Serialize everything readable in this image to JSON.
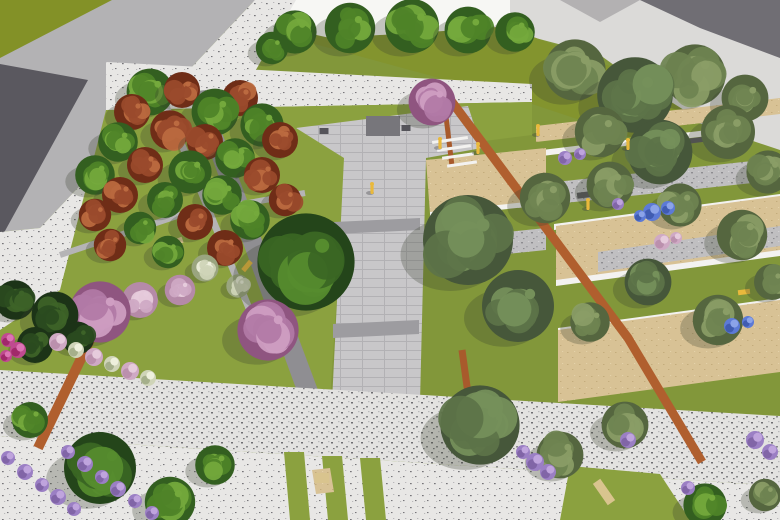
{
  "scene": {
    "description": "Aerial 3D rendering of a park landscape design with tree grove, central paved walkway, terraced sand garden, flower beds and promenade",
    "palette": {
      "lawn_base": "#82973a",
      "lawn_top": "#83942e",
      "lawn_bright": "#8ba13f",
      "olive_corner": "#839127",
      "road": "#b3b2b4",
      "road_shadow": "#504e55",
      "sidewalk_bg": "#e8e7e5",
      "speck_dark": "#77767a",
      "speck_mid": "#b9b8ba",
      "building_white": "#f7f7f4",
      "building_shade": "#e4e3e1",
      "pav_topright": "#dbdad8",
      "shadow_dark": "#55525b",
      "plaza_bg": "#c8c7c9",
      "plaza_line": "#b2b1b4",
      "plaza_dark": "#9d9ca0",
      "stone_bg": "#c0bfc1",
      "sand": "#d8c295",
      "sand_dot": "#c3ac7c",
      "white_wall": "#f3f2f0",
      "grove_band": "#8f8e92",
      "grove_path": "#b5b4b6",
      "corten": "#b05f2e",
      "trunk": "#a85a2c",
      "monument": "#77767b",
      "monument_dark": "#55545a",
      "yellow": "#e9b93c",
      "tan_bench": "#d9c48e",
      "dark_bench": "#5a595e",
      "shadow_veg": "#39402e"
    },
    "tree_palettes": {
      "g": [
        "#335f20",
        "#4f8328",
        "#74a93c"
      ],
      "gd": [
        "#24451a",
        "#3a6623",
        "#568c2e"
      ],
      "o": [
        "#55663f",
        "#6e8351",
        "#8a9d66"
      ],
      "od": [
        "#46573a",
        "#5d7348",
        "#75905a"
      ],
      "r": [
        "#6f2d17",
        "#9a4a2c",
        "#bb6a40"
      ],
      "p": [
        "#8f5580",
        "#b27aa6",
        "#cf9ec2"
      ],
      "pl": [
        "#b58aa8",
        "#cfa9c4",
        "#e6cbdc"
      ],
      "c": [
        "#1c3317",
        "#2a4a1f",
        "#3d6328"
      ],
      "w": [
        "#9aa57f",
        "#cfd4b8",
        "#eef0dd"
      ],
      "l": [
        "#7a5fa0",
        "#9b7fc4",
        "#bfa4dd"
      ],
      "m": [
        "#992060",
        "#c04a90",
        "#dd74b4"
      ],
      "b": [
        "#3a55a8",
        "#5c7ad6",
        "#8ba3e8"
      ]
    },
    "grounds": [
      {
        "name": "base-lawn",
        "pts": "0,0 780,0 780,520 0,520",
        "fill": "lawn_base"
      },
      {
        "name": "top-right-pavement",
        "pts": "470,0 780,0 780,150 690,120 600,55 505,30",
        "fill": "pav_topright"
      },
      {
        "name": "top-lawn-band",
        "pts": "258,16 510,28 620,70 700,120 640,140 520,100 300,40",
        "fill": "lawn_top"
      },
      {
        "name": "buildings-top",
        "pts": "252,0 510,0 510,26 430,32 330,38 258,22",
        "fill": "building_white"
      },
      {
        "name": "building-facet",
        "pts": "252,0 292,0 262,26",
        "fill": "building_shade"
      },
      {
        "name": "top-shadow-wedge",
        "pts": "640,0 780,0 780,58 700,28",
        "fill": "shadow_dark",
        "op": 0.8
      },
      {
        "name": "top-shadow-wedge-2",
        "pts": "560,0 640,0 600,22",
        "fill": "shadow_dark",
        "op": 0.3
      },
      {
        "name": "olive-corner",
        "pts": "0,0 112,0 0,58",
        "fill": "olive_corner"
      },
      {
        "name": "road",
        "pts": "112,0 255,0 40,228 0,232 0,58",
        "fill": "road"
      },
      {
        "name": "road-shadow",
        "pts": "0,64 88,80 0,240",
        "fill": "road_shadow",
        "op": 0.9
      },
      {
        "name": "sidewalk",
        "pts": "255,0 296,0 100,342 62,372 0,372 0,232 40,228",
        "fill": "@speckle"
      },
      {
        "name": "white-strip",
        "pts": "106,62 532,84 532,102 106,110",
        "fill": "@speckle"
      },
      {
        "name": "lawn-bright-grove",
        "pts": "106,110 532,102 532,135 430,148 346,158 330,400 0,374 0,330 60,290",
        "fill": "lawn_bright"
      },
      {
        "name": "grove-dark-band",
        "pts": "188,92 206,90 318,390 298,394",
        "fill": "grove_band"
      },
      {
        "name": "plaza-walkway",
        "pts": "296,128 468,106 482,148 426,158 420,402 332,402 344,158",
        "fill": "@paving"
      },
      {
        "name": "walk-cross-1",
        "pts": "334,222 420,218 420,230 334,234",
        "fill": "plaza_dark"
      },
      {
        "name": "walk-cross-2",
        "pts": "333,324 419,320 419,334 333,338",
        "fill": "plaza_dark"
      },
      {
        "name": "right-sand-1",
        "pts": "536,126 780,98 780,114 536,142",
        "fill": "@sand"
      },
      {
        "name": "right-wall-1",
        "pts": "542,150 724,128 724,134 542,156",
        "fill": "white_wall"
      },
      {
        "name": "right-stone-1",
        "pts": "518,186 780,158 780,180 518,208",
        "fill": "@stone"
      },
      {
        "name": "right-wall-2",
        "pts": "554,224 780,194 780,200 554,230",
        "fill": "white_wall"
      },
      {
        "name": "right-sand-2",
        "pts": "556,226 780,196 780,252 556,282",
        "fill": "@sand"
      },
      {
        "name": "right-stone-2",
        "pts": "598,252 780,226 780,246 598,272",
        "fill": "@stone"
      },
      {
        "name": "right-wall-2b",
        "pts": "556,280 780,250 780,256 556,286",
        "fill": "white_wall"
      },
      {
        "name": "right-wall-3",
        "pts": "558,328 780,298 780,304 558,334",
        "fill": "white_wall"
      },
      {
        "name": "right-sand-3",
        "pts": "558,330 780,300 780,372 558,402",
        "fill": "@sand"
      },
      {
        "name": "left-sand-block",
        "pts": "426,160 546,148 546,204 430,214",
        "fill": "@sand"
      },
      {
        "name": "left-sand-wall",
        "pts": "430,212 546,200 546,205 430,217",
        "fill": "white_wall"
      },
      {
        "name": "left-stone-block",
        "pts": "430,240 546,228 546,250 430,262",
        "fill": "@stone"
      },
      {
        "name": "promenade",
        "pts": "0,370 780,416 780,486 0,436",
        "fill": "@speckle2"
      },
      {
        "name": "bottom-band",
        "pts": "0,436 780,486 780,520 0,520",
        "fill": "@speckle"
      },
      {
        "name": "grass-strip-1",
        "pts": "284,452 304,452 310,520 290,520",
        "fill": "lawn_bright"
      },
      {
        "name": "grass-strip-2",
        "pts": "322,456 342,456 348,520 328,520",
        "fill": "lawn_bright"
      },
      {
        "name": "grass-strip-3",
        "pts": "360,458 380,458 386,520 366,520",
        "fill": "lawn_bright"
      },
      {
        "name": "dirt-patch",
        "pts": "312,470 330,468 334,492 316,494",
        "fill": "@sand"
      },
      {
        "name": "bottom-right-lawn",
        "pts": "570,466 660,474 690,520 560,520",
        "fill": "lawn_bright"
      }
    ],
    "strokes": [
      {
        "name": "corten-path-main",
        "pts": "446,94 628,338 702,462",
        "fill": "corten",
        "w": 9
      },
      {
        "name": "corten-path-left",
        "pts": "90,340 38,448",
        "fill": "corten",
        "w": 10
      },
      {
        "name": "tall-trunk-1",
        "pts": "462,350 476,452",
        "fill": "trunk",
        "w": 7
      },
      {
        "name": "tall-trunk-2",
        "pts": "444,100 452,166",
        "fill": "trunk",
        "w": 5
      },
      {
        "name": "grove-path-1",
        "pts": "152,72 262,340",
        "fill": "grove_path",
        "w": 7
      },
      {
        "name": "grove-path-2",
        "pts": "60,255 180,215 305,193",
        "fill": "grove_path",
        "w": 6
      }
    ],
    "bars": [
      {
        "name": "monument",
        "x": 383,
        "y": 126,
        "w": 34,
        "h": 20,
        "rot": 0,
        "fill": "monument"
      },
      {
        "name": "monument-dot-left",
        "x": 324,
        "y": 131,
        "w": 9,
        "h": 6,
        "rot": 0,
        "fill": "monument_dark"
      },
      {
        "name": "monument-dot-right",
        "x": 406,
        "y": 128,
        "w": 9,
        "h": 6,
        "rot": 0,
        "fill": "monument_dark"
      },
      {
        "name": "step-1",
        "x": 450,
        "y": 140,
        "w": 36,
        "h": 3,
        "rot": -8,
        "fill": "white_wall"
      },
      {
        "name": "step-2",
        "x": 454,
        "y": 148,
        "w": 34,
        "h": 3,
        "rot": -8,
        "fill": "white_wall"
      },
      {
        "name": "step-3",
        "x": 458,
        "y": 156,
        "w": 32,
        "h": 3,
        "rot": -8,
        "fill": "white_wall"
      },
      {
        "name": "step-4",
        "x": 462,
        "y": 164,
        "w": 30,
        "h": 3,
        "rot": -8,
        "fill": "white_wall"
      },
      {
        "name": "dark-bench-1",
        "x": 592,
        "y": 194,
        "w": 30,
        "h": 6,
        "rot": -7,
        "fill": "dark_bench"
      },
      {
        "name": "dark-bench-2",
        "x": 698,
        "y": 140,
        "w": 24,
        "h": 5,
        "rot": -7,
        "fill": "dark_bench"
      },
      {
        "name": "tan-bench-1",
        "x": 176,
        "y": 242,
        "w": 14,
        "h": 6,
        "rot": -20,
        "fill": "tan_bench"
      },
      {
        "name": "tan-bench-2",
        "x": 604,
        "y": 492,
        "w": 26,
        "h": 9,
        "rot": 55,
        "fill": "tan_bench"
      },
      {
        "name": "tan-bench-3",
        "x": 322,
        "y": 478,
        "w": 14,
        "h": 10,
        "rot": 0,
        "fill": "tan_bench"
      },
      {
        "name": "yellow-bench-1",
        "x": 112,
        "y": 200,
        "w": 12,
        "h": 5,
        "rot": -50,
        "fill": "yellow"
      },
      {
        "name": "yellow-bench-2",
        "x": 247,
        "y": 266,
        "w": 12,
        "h": 5,
        "rot": -50,
        "fill": "yellow"
      },
      {
        "name": "yellow-bench-3",
        "x": 744,
        "y": 292,
        "w": 12,
        "h": 5,
        "rot": -7,
        "fill": "yellow"
      }
    ],
    "trees": [
      [
        295,
        32,
        24,
        "g"
      ],
      [
        350,
        28,
        28,
        "g"
      ],
      [
        412,
        26,
        30,
        "g"
      ],
      [
        468,
        30,
        26,
        "g"
      ],
      [
        272,
        48,
        18,
        "g"
      ],
      [
        515,
        32,
        22,
        "g"
      ],
      [
        575,
        70,
        34,
        "o"
      ],
      [
        695,
        75,
        34,
        "o"
      ],
      [
        745,
        98,
        26,
        "o"
      ],
      [
        635,
        95,
        42,
        "od"
      ],
      [
        600,
        132,
        28,
        "o"
      ],
      [
        728,
        132,
        30,
        "o"
      ],
      [
        660,
        152,
        36,
        "od"
      ],
      [
        768,
        172,
        24,
        "o"
      ],
      [
        432,
        102,
        26,
        "p"
      ],
      [
        150,
        92,
        26,
        "g"
      ],
      [
        182,
        90,
        20,
        "r"
      ],
      [
        240,
        98,
        20,
        "r"
      ],
      [
        215,
        112,
        26,
        "g"
      ],
      [
        132,
        112,
        20,
        "r"
      ],
      [
        262,
        125,
        24,
        "g"
      ],
      [
        170,
        130,
        22,
        "r"
      ],
      [
        118,
        142,
        22,
        "g"
      ],
      [
        205,
        142,
        20,
        "r"
      ],
      [
        280,
        140,
        20,
        "r"
      ],
      [
        235,
        158,
        22,
        "g"
      ],
      [
        145,
        165,
        20,
        "r"
      ],
      [
        95,
        175,
        22,
        "g"
      ],
      [
        190,
        172,
        24,
        "g"
      ],
      [
        262,
        175,
        20,
        "r"
      ],
      [
        120,
        195,
        20,
        "r"
      ],
      [
        222,
        195,
        22,
        "g"
      ],
      [
        165,
        200,
        20,
        "g"
      ],
      [
        285,
        200,
        18,
        "r"
      ],
      [
        95,
        215,
        18,
        "r"
      ],
      [
        195,
        222,
        20,
        "r"
      ],
      [
        250,
        220,
        22,
        "g"
      ],
      [
        140,
        228,
        18,
        "g"
      ],
      [
        110,
        245,
        18,
        "r"
      ],
      [
        225,
        248,
        20,
        "r"
      ],
      [
        168,
        252,
        18,
        "g"
      ],
      [
        205,
        268,
        15,
        "w"
      ],
      [
        238,
        286,
        13,
        "w"
      ],
      [
        306,
        262,
        54,
        "gd"
      ],
      [
        545,
        198,
        28,
        "o"
      ],
      [
        468,
        240,
        50,
        "od"
      ],
      [
        518,
        306,
        40,
        "od"
      ],
      [
        610,
        185,
        26,
        "o"
      ],
      [
        680,
        205,
        24,
        "o"
      ],
      [
        742,
        235,
        28,
        "o"
      ],
      [
        648,
        282,
        26,
        "od"
      ],
      [
        718,
        320,
        28,
        "o"
      ],
      [
        590,
        322,
        22,
        "o"
      ],
      [
        772,
        282,
        20,
        "o"
      ],
      [
        140,
        300,
        20,
        "pl"
      ],
      [
        180,
        290,
        17,
        "pl"
      ],
      [
        100,
        312,
        34,
        "p"
      ],
      [
        268,
        330,
        34,
        "p"
      ],
      [
        15,
        300,
        22,
        "c"
      ],
      [
        55,
        315,
        26,
        "c"
      ],
      [
        35,
        345,
        20,
        "c"
      ],
      [
        78,
        338,
        18,
        "c"
      ],
      [
        30,
        420,
        20,
        "g"
      ],
      [
        100,
        468,
        40,
        "gd"
      ],
      [
        170,
        502,
        28,
        "g"
      ],
      [
        215,
        465,
        22,
        "g"
      ],
      [
        480,
        425,
        44,
        "od"
      ],
      [
        560,
        455,
        26,
        "o"
      ],
      [
        625,
        425,
        26,
        "o"
      ],
      [
        705,
        505,
        24,
        "g"
      ],
      [
        765,
        495,
        18,
        "o"
      ]
    ],
    "shrubs": [
      [
        8,
        458,
        7,
        "l"
      ],
      [
        25,
        472,
        8,
        "l"
      ],
      [
        42,
        485,
        7,
        "l"
      ],
      [
        58,
        497,
        8,
        "l"
      ],
      [
        74,
        509,
        7,
        "l"
      ],
      [
        68,
        452,
        7,
        "l"
      ],
      [
        85,
        464,
        8,
        "l"
      ],
      [
        102,
        477,
        7,
        "l"
      ],
      [
        118,
        489,
        8,
        "l"
      ],
      [
        135,
        501,
        7,
        "l"
      ],
      [
        152,
        513,
        7,
        "l"
      ],
      [
        58,
        342,
        9,
        "pl"
      ],
      [
        76,
        350,
        8,
        "w"
      ],
      [
        94,
        357,
        9,
        "pl"
      ],
      [
        112,
        364,
        8,
        "w"
      ],
      [
        130,
        371,
        9,
        "pl"
      ],
      [
        148,
        378,
        8,
        "w"
      ],
      [
        8,
        340,
        7,
        "m"
      ],
      [
        18,
        350,
        8,
        "m"
      ],
      [
        6,
        356,
        6,
        "m"
      ],
      [
        652,
        212,
        9,
        "b"
      ],
      [
        668,
        208,
        7,
        "b"
      ],
      [
        640,
        216,
        6,
        "b"
      ],
      [
        732,
        326,
        8,
        "b"
      ],
      [
        748,
        322,
        6,
        "b"
      ],
      [
        565,
        158,
        7,
        "l"
      ],
      [
        580,
        154,
        6,
        "l"
      ],
      [
        618,
        204,
        6,
        "l"
      ],
      [
        662,
        242,
        8,
        "pl"
      ],
      [
        676,
        238,
        6,
        "pl"
      ],
      [
        535,
        462,
        9,
        "l"
      ],
      [
        548,
        472,
        8,
        "l"
      ],
      [
        755,
        440,
        9,
        "l"
      ],
      [
        770,
        452,
        8,
        "l"
      ],
      [
        628,
        440,
        8,
        "l"
      ],
      [
        688,
        488,
        7,
        "l"
      ],
      [
        523,
        452,
        7,
        "l"
      ]
    ],
    "figures": [
      [
        372,
        190
      ],
      [
        588,
        206
      ],
      [
        538,
        132
      ],
      [
        628,
        146
      ],
      [
        440,
        145
      ],
      [
        478,
        150
      ]
    ]
  }
}
